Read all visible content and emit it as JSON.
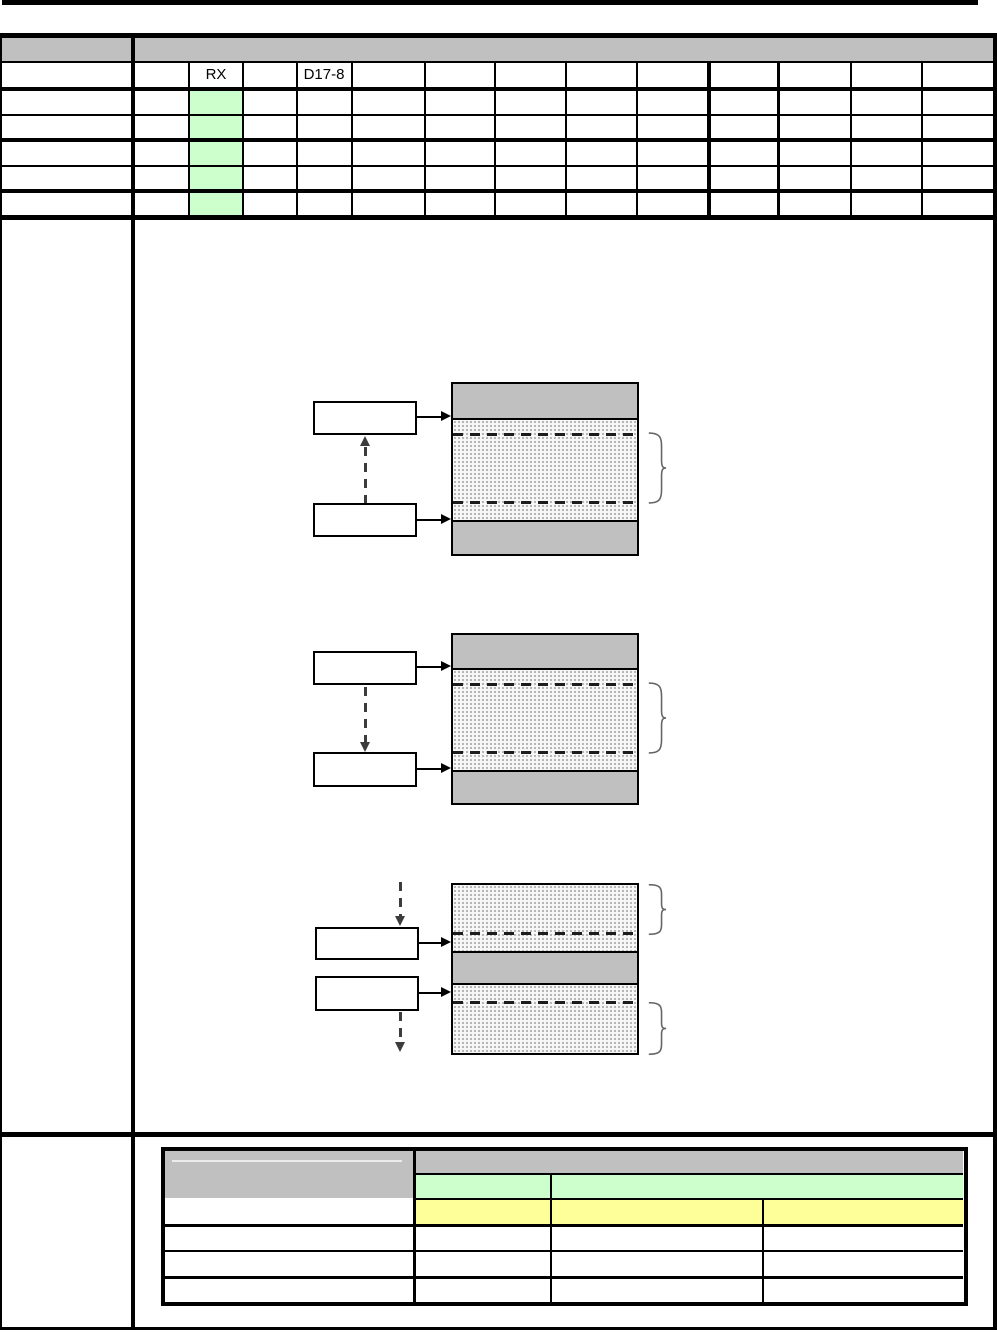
{
  "top_table": {
    "labels": {
      "rx": "RX",
      "d17_8": "D17-8"
    },
    "highlighted_column": "rx",
    "highlighted_rows": 5
  },
  "colors": {
    "header_gray": "#C0C0C0",
    "highlight_green": "#CCFFCC",
    "highlight_yellow": "#FFFF99",
    "memory_band_gray": "#C0C0C0"
  },
  "diagrams": {
    "count": 3
  },
  "bottom_table": {
    "rows": 6,
    "columns": 4
  }
}
